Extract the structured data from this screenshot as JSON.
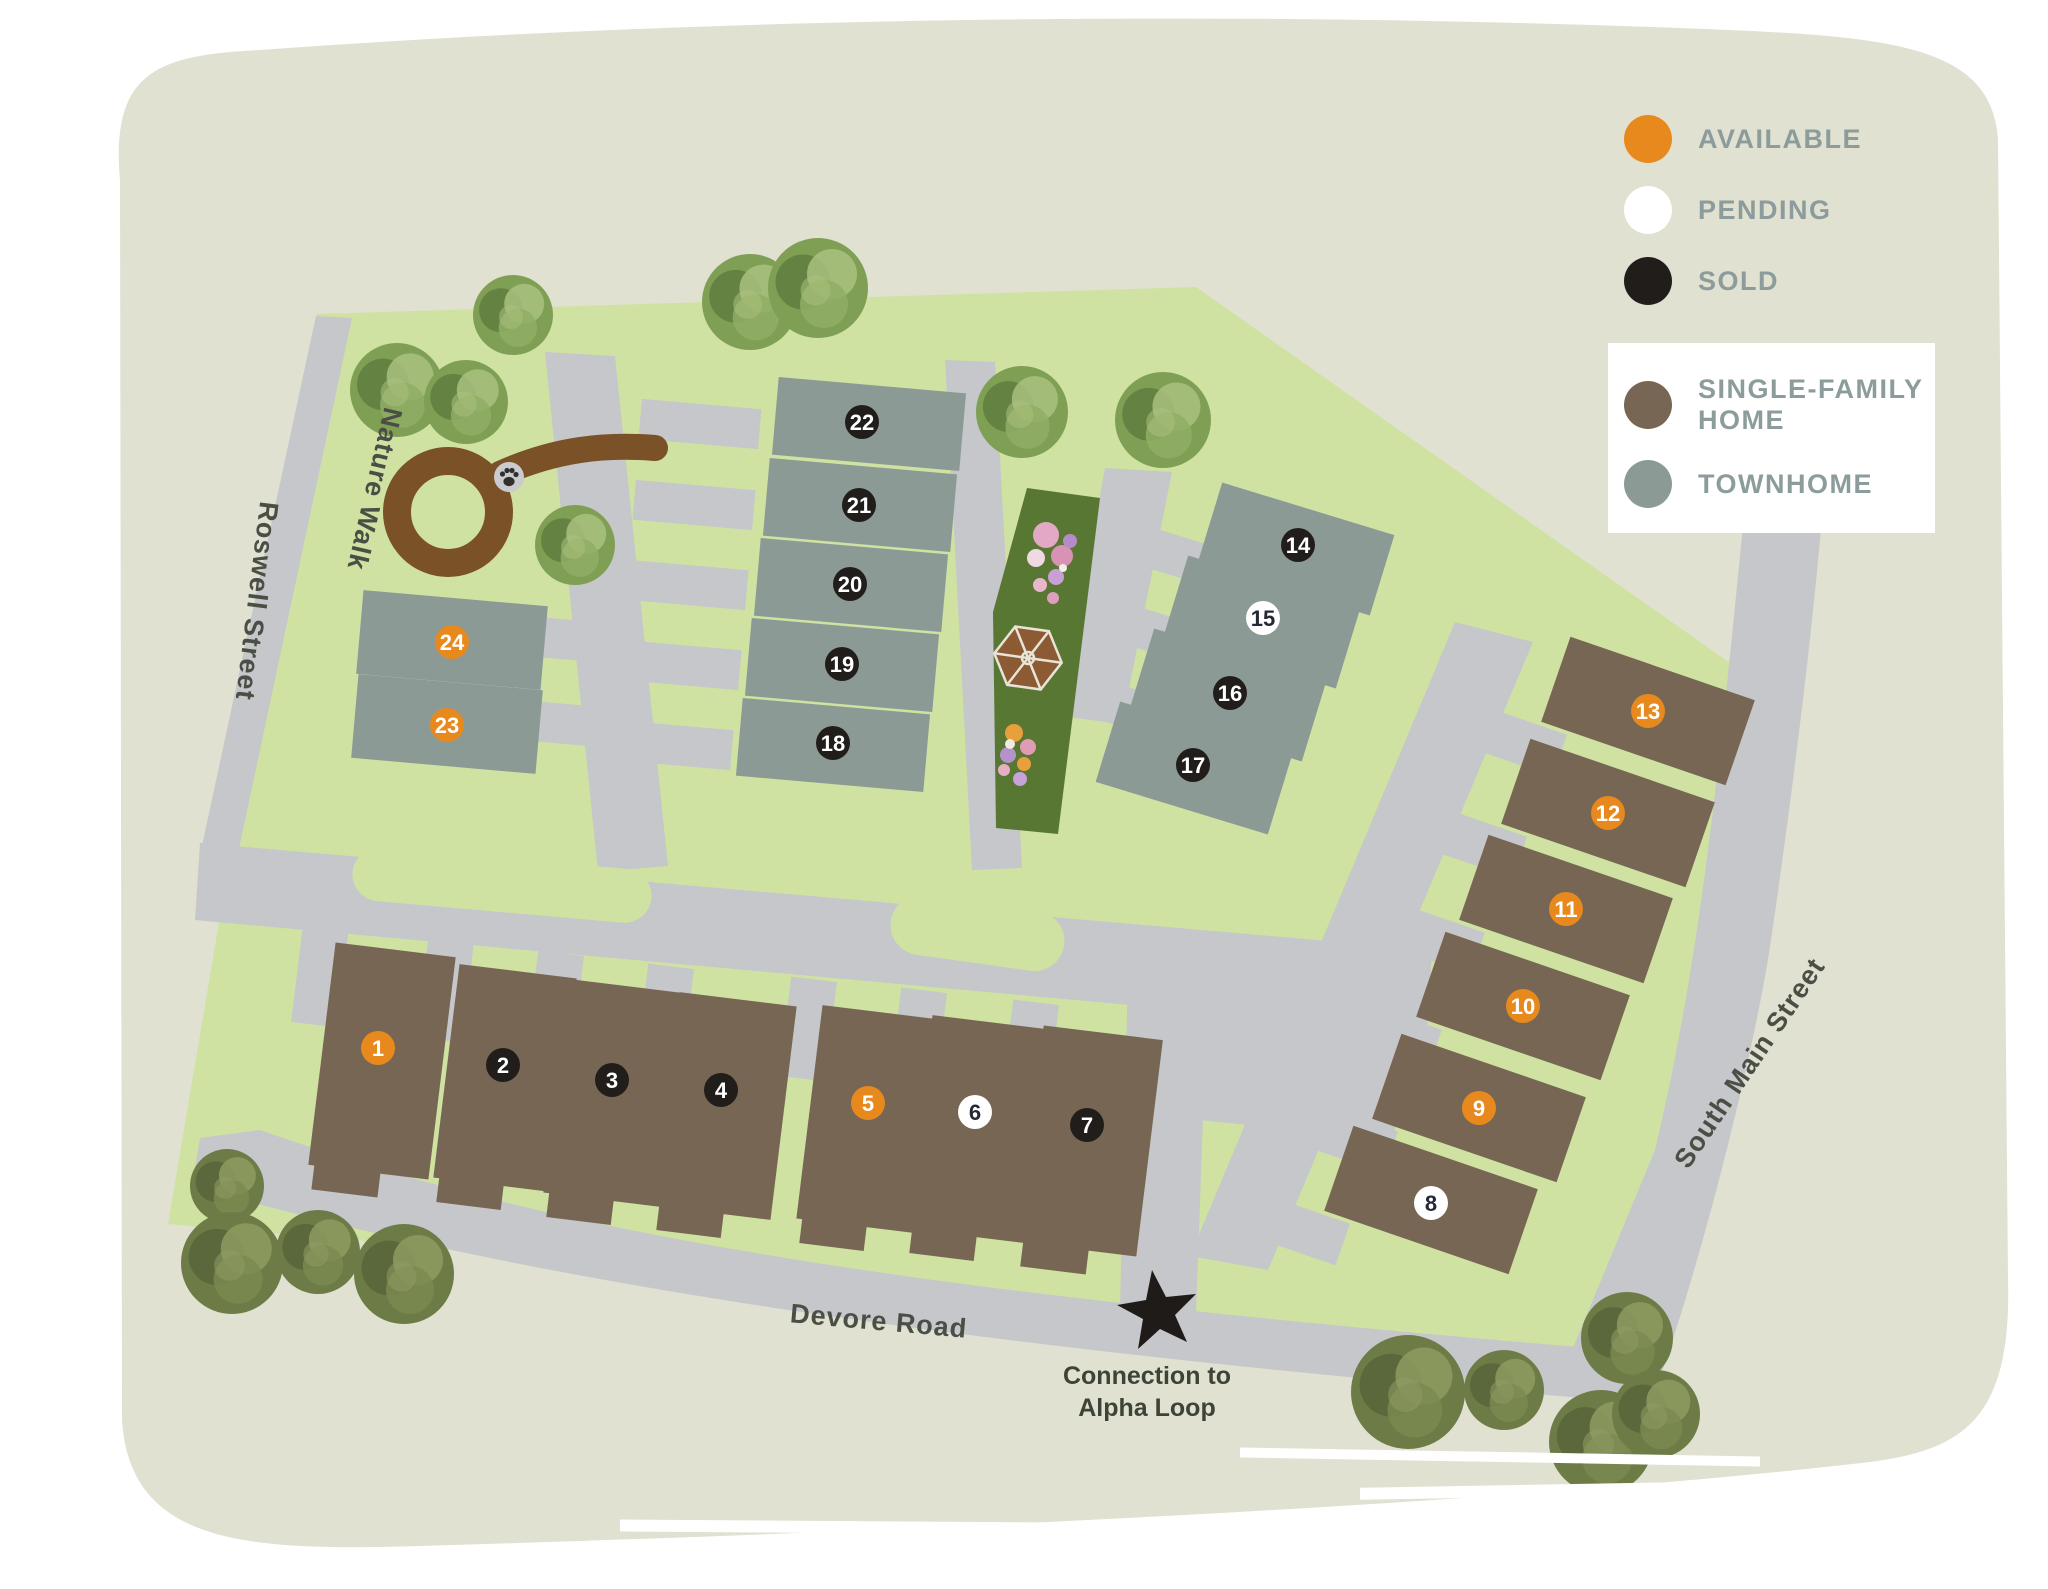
{
  "legend": {
    "statuses": [
      {
        "label": "AVAILABLE",
        "key": "available"
      },
      {
        "label": "PENDING",
        "key": "pending"
      },
      {
        "label": "SOLD",
        "key": "sold"
      }
    ],
    "types": [
      {
        "lines": [
          "SINGLE-FAMILY",
          "HOME"
        ],
        "key": "single_family"
      },
      {
        "lines": [
          "TOWNHOME"
        ],
        "key": "townhome"
      }
    ]
  },
  "colors": {
    "available": "#e8891d",
    "pending": "#ffffff",
    "sold": "#211d1b",
    "pending_text": "#232a36",
    "single_family": "#776653",
    "townhome": "#8c9a96",
    "site_green": "#cfe2a2",
    "road_gray": "#c5c7cb",
    "park_green": "#587733",
    "path_brown": "#7b5128",
    "gazebo_brown": "#8d5b33",
    "legend_text": "#8c9c9c",
    "map_text": "#4a4f45",
    "tree_a": [
      "#7fa054",
      "#5e7a3d",
      "#a9c17e",
      "#8fae64"
    ],
    "tree_b": [
      "#6d7c47",
      "#55633a",
      "#8e9c62",
      "#7a8a50"
    ]
  },
  "map": {
    "streets": {
      "roswell": "Roswell Street",
      "nature_walk": "Nature Walk",
      "devore": "Devore Road",
      "south_main": "South Main Street"
    },
    "connection": {
      "line1": "Connection to",
      "line2": "Alpha Loop"
    },
    "trees": [
      {
        "x": 397,
        "y": 390,
        "r": 47,
        "p": "tree_a"
      },
      {
        "x": 466,
        "y": 402,
        "r": 42,
        "p": "tree_a"
      },
      {
        "x": 513,
        "y": 315,
        "r": 40,
        "p": "tree_a"
      },
      {
        "x": 575,
        "y": 545,
        "r": 40,
        "p": "tree_a"
      },
      {
        "x": 750,
        "y": 302,
        "r": 48,
        "p": "tree_a"
      },
      {
        "x": 818,
        "y": 288,
        "r": 50,
        "p": "tree_a"
      },
      {
        "x": 1022,
        "y": 412,
        "r": 46,
        "p": "tree_a"
      },
      {
        "x": 1163,
        "y": 420,
        "r": 48,
        "p": "tree_a"
      },
      {
        "x": 227,
        "y": 1186,
        "r": 37,
        "p": "tree_b"
      },
      {
        "x": 232,
        "y": 1263,
        "r": 51,
        "p": "tree_b"
      },
      {
        "x": 318,
        "y": 1252,
        "r": 42,
        "p": "tree_b"
      },
      {
        "x": 404,
        "y": 1274,
        "r": 50,
        "p": "tree_b"
      },
      {
        "x": 1408,
        "y": 1392,
        "r": 57,
        "p": "tree_b"
      },
      {
        "x": 1504,
        "y": 1390,
        "r": 40,
        "p": "tree_b"
      },
      {
        "x": 1627,
        "y": 1338,
        "r": 46,
        "p": "tree_b"
      },
      {
        "x": 1601,
        "y": 1442,
        "r": 52,
        "p": "tree_b"
      },
      {
        "x": 1656,
        "y": 1414,
        "r": 44,
        "p": "tree_b"
      }
    ],
    "lots": [
      {
        "number": "1",
        "status": "available",
        "type": "single-family",
        "marker": {
          "x": 378,
          "y": 1048
        },
        "building": {
          "x": 382,
          "y": 1061,
          "w": 121,
          "h": 224,
          "rot": 7
        }
      },
      {
        "number": "2",
        "status": "sold",
        "type": "single-family",
        "marker": {
          "x": 503,
          "y": 1065
        },
        "building": {
          "x": 505,
          "y": 1078,
          "w": 118,
          "h": 215,
          "rot": 7
        }
      },
      {
        "number": "3",
        "status": "sold",
        "type": "single-family",
        "marker": {
          "x": 612,
          "y": 1080
        },
        "building": {
          "x": 615,
          "y": 1093,
          "w": 118,
          "h": 215,
          "rot": 7
        }
      },
      {
        "number": "4",
        "status": "sold",
        "type": "single-family",
        "marker": {
          "x": 721,
          "y": 1090
        },
        "building": {
          "x": 725,
          "y": 1106,
          "w": 118,
          "h": 215,
          "rot": 7
        }
      },
      {
        "number": "5",
        "status": "available",
        "type": "single-family",
        "marker": {
          "x": 868,
          "y": 1103
        },
        "building": {
          "x": 868,
          "y": 1119,
          "w": 118,
          "h": 215,
          "rot": 7
        }
      },
      {
        "number": "6",
        "status": "pending",
        "type": "single-family",
        "marker": {
          "x": 975,
          "y": 1112
        },
        "building": {
          "x": 978,
          "y": 1129,
          "w": 118,
          "h": 215,
          "rot": 7
        }
      },
      {
        "number": "7",
        "status": "sold",
        "type": "single-family",
        "marker": {
          "x": 1087,
          "y": 1125
        },
        "building": {
          "x": 1090,
          "y": 1141,
          "w": 120,
          "h": 218,
          "rot": 7
        }
      },
      {
        "number": "8",
        "status": "pending",
        "type": "single-family",
        "marker": {
          "x": 1431,
          "y": 1203
        },
        "building": {
          "x": 1431,
          "y": 1200,
          "w": 195,
          "h": 90,
          "rot": 19
        }
      },
      {
        "number": "9",
        "status": "available",
        "type": "single-family",
        "marker": {
          "x": 1479,
          "y": 1108
        },
        "building": {
          "x": 1479,
          "y": 1108,
          "w": 195,
          "h": 90,
          "rot": 19
        }
      },
      {
        "number": "10",
        "status": "available",
        "type": "single-family",
        "marker": {
          "x": 1523,
          "y": 1006
        },
        "building": {
          "x": 1523,
          "y": 1006,
          "w": 195,
          "h": 90,
          "rot": 19
        }
      },
      {
        "number": "11",
        "status": "available",
        "type": "single-family",
        "marker": {
          "x": 1566,
          "y": 909
        },
        "building": {
          "x": 1566,
          "y": 909,
          "w": 195,
          "h": 90,
          "rot": 19
        }
      },
      {
        "number": "12",
        "status": "available",
        "type": "single-family",
        "marker": {
          "x": 1608,
          "y": 813
        },
        "building": {
          "x": 1608,
          "y": 813,
          "w": 195,
          "h": 90,
          "rot": 19
        }
      },
      {
        "number": "13",
        "status": "available",
        "type": "single-family",
        "marker": {
          "x": 1648,
          "y": 711
        },
        "building": {
          "x": 1648,
          "y": 711,
          "w": 195,
          "h": 90,
          "rot": 19
        }
      },
      {
        "number": "14",
        "status": "sold",
        "type": "townhome",
        "marker": {
          "x": 1298,
          "y": 545
        },
        "building": {
          "x": 1296,
          "y": 549,
          "w": 180,
          "h": 84,
          "rot": 17
        }
      },
      {
        "number": "15",
        "status": "pending",
        "type": "townhome",
        "marker": {
          "x": 1263,
          "y": 618
        },
        "building": {
          "x": 1262,
          "y": 622,
          "w": 180,
          "h": 84,
          "rot": 17
        }
      },
      {
        "number": "16",
        "status": "sold",
        "type": "townhome",
        "marker": {
          "x": 1230,
          "y": 693
        },
        "building": {
          "x": 1228,
          "y": 695,
          "w": 180,
          "h": 84,
          "rot": 17
        }
      },
      {
        "number": "17",
        "status": "sold",
        "type": "townhome",
        "marker": {
          "x": 1193,
          "y": 765
        },
        "building": {
          "x": 1194,
          "y": 768,
          "w": 180,
          "h": 84,
          "rot": 17
        }
      },
      {
        "number": "18",
        "status": "sold",
        "type": "townhome",
        "marker": {
          "x": 833,
          "y": 743
        },
        "building": {
          "x": 833,
          "y": 745,
          "w": 188,
          "h": 78,
          "rot": 5
        }
      },
      {
        "number": "19",
        "status": "sold",
        "type": "townhome",
        "marker": {
          "x": 842,
          "y": 664
        },
        "building": {
          "x": 842,
          "y": 665,
          "w": 188,
          "h": 78,
          "rot": 5
        }
      },
      {
        "number": "20",
        "status": "sold",
        "type": "townhome",
        "marker": {
          "x": 850,
          "y": 584
        },
        "building": {
          "x": 851,
          "y": 585,
          "w": 188,
          "h": 78,
          "rot": 5
        }
      },
      {
        "number": "21",
        "status": "sold",
        "type": "townhome",
        "marker": {
          "x": 859,
          "y": 505
        },
        "building": {
          "x": 860,
          "y": 505,
          "w": 188,
          "h": 78,
          "rot": 5
        }
      },
      {
        "number": "22",
        "status": "sold",
        "type": "townhome",
        "marker": {
          "x": 862,
          "y": 422
        },
        "building": {
          "x": 869,
          "y": 424,
          "w": 188,
          "h": 78,
          "rot": 5
        }
      },
      {
        "number": "23",
        "status": "available",
        "type": "townhome",
        "marker": {
          "x": 447,
          "y": 725
        },
        "building": {
          "x": 447,
          "y": 724,
          "w": 185,
          "h": 84,
          "rot": 5
        }
      },
      {
        "number": "24",
        "status": "available",
        "type": "townhome",
        "marker": {
          "x": 452,
          "y": 642
        },
        "building": {
          "x": 452,
          "y": 640,
          "w": 185,
          "h": 84,
          "rot": 5
        }
      }
    ]
  }
}
